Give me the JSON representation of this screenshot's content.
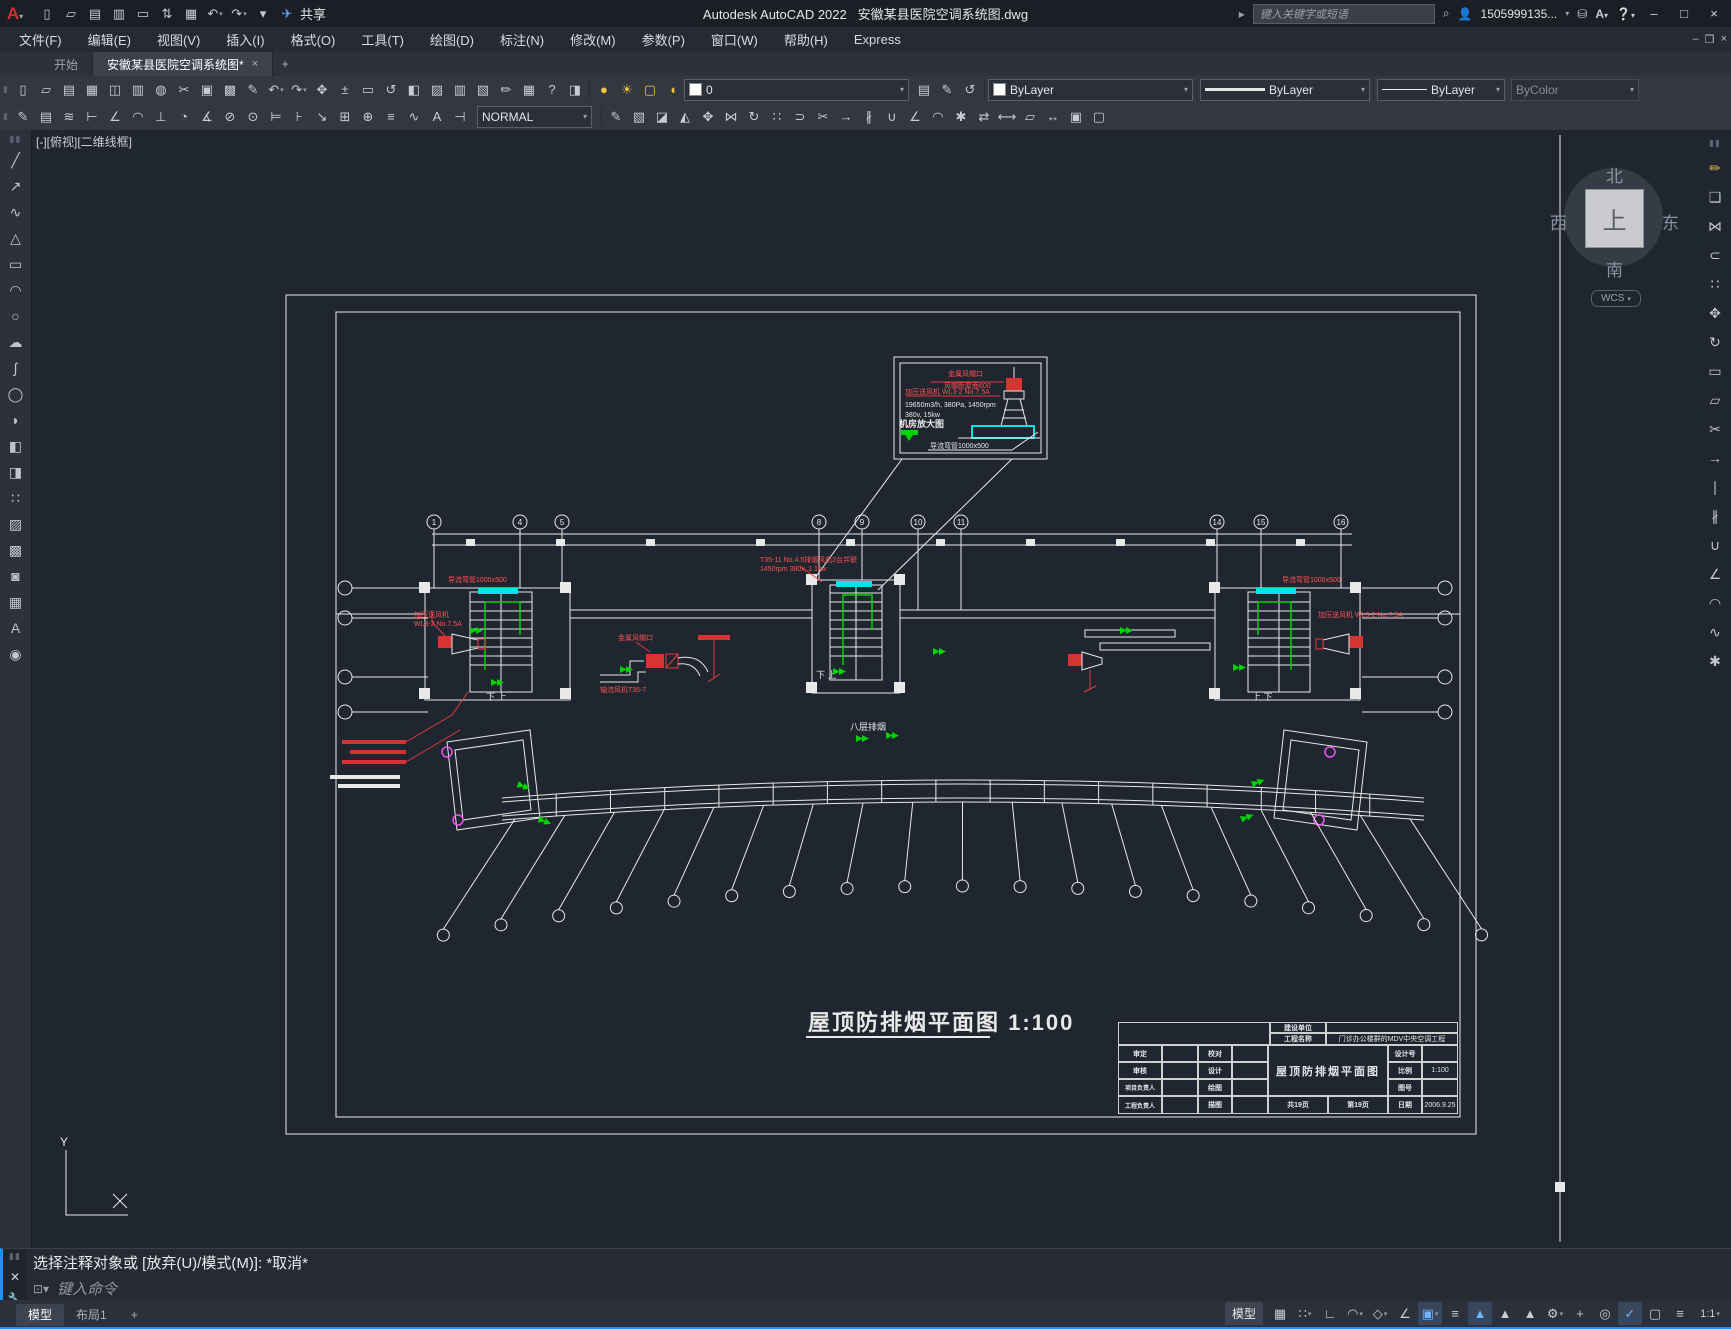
{
  "titlebar": {
    "app_title": "Autodesk AutoCAD 2022",
    "doc_title": "安徽某县医院空调系统图.dwg",
    "share_label": "共享",
    "search_placeholder": "键入关键字或短语",
    "username": "1505999135...",
    "min": "–",
    "max": "□",
    "close": "×",
    "doc_min": "–",
    "doc_restore": "❐",
    "doc_close": "×"
  },
  "menu": {
    "items": [
      "文件(F)",
      "编辑(E)",
      "视图(V)",
      "插入(I)",
      "格式(O)",
      "工具(T)",
      "绘图(D)",
      "标注(N)",
      "修改(M)",
      "参数(P)",
      "窗口(W)",
      "帮助(H)",
      "Express"
    ]
  },
  "tabs": {
    "start": "开始",
    "doc": "安徽某县医院空调系统图*",
    "close": "×",
    "plus": "+"
  },
  "toolbar": {
    "layer_name": "0",
    "color": "ByLayer",
    "lineweight": "ByLayer",
    "linetype": "ByLayer",
    "plotstyle": "ByColor",
    "dimstyle": "NORMAL"
  },
  "icons": {
    "qat": [
      {
        "n": "new",
        "g": "▯"
      },
      {
        "n": "open",
        "g": "▱"
      },
      {
        "n": "save",
        "g": "▤"
      },
      {
        "n": "save-as",
        "g": "▥"
      },
      {
        "n": "plot-stamp",
        "g": "▭"
      },
      {
        "n": "transfer",
        "g": "⇅"
      },
      {
        "n": "print",
        "g": "▦"
      },
      {
        "n": "undo",
        "g": "↶",
        "dd": true
      },
      {
        "n": "redo",
        "g": "↷",
        "dd": true
      },
      {
        "n": "qat-more",
        "g": "▾"
      },
      {
        "n": "share",
        "g": "✈",
        "c": "#58a6ff"
      }
    ],
    "tb1_left": [
      {
        "n": "new-file",
        "g": "▯"
      },
      {
        "n": "open-file",
        "g": "▱"
      },
      {
        "n": "save-file",
        "g": "▤"
      },
      {
        "n": "print",
        "g": "▦"
      },
      {
        "n": "plot-preview",
        "g": "◫"
      },
      {
        "n": "publish",
        "g": "▥"
      },
      {
        "n": "web",
        "g": "◍"
      },
      {
        "n": "cut",
        "g": "✂"
      },
      {
        "n": "copy-clip",
        "g": "▣"
      },
      {
        "n": "paste",
        "g": "▩"
      },
      {
        "n": "match-properties",
        "g": "✎"
      },
      {
        "n": "undo",
        "g": "↶",
        "dd": true
      },
      {
        "n": "redo",
        "g": "↷",
        "dd": true
      },
      {
        "n": "pan",
        "g": "✥"
      },
      {
        "n": "zoom-realtime",
        "g": "±"
      },
      {
        "n": "zoom-window",
        "g": "▭"
      },
      {
        "n": "zoom-previous",
        "g": "↺"
      },
      {
        "n": "properties",
        "g": "◧"
      },
      {
        "n": "design-center",
        "g": "▨"
      },
      {
        "n": "tool-palettes",
        "g": "▥"
      },
      {
        "n": "sheet-set",
        "g": "▧"
      },
      {
        "n": "markup",
        "g": "✏"
      },
      {
        "n": "calculator",
        "g": "▦"
      },
      {
        "n": "help",
        "g": "?"
      },
      {
        "n": "infocenter",
        "g": "◨"
      }
    ],
    "tb1_layer": [
      {
        "n": "layer-on",
        "g": "●",
        "c": "#f5c542"
      },
      {
        "n": "layer-thaw",
        "g": "☀",
        "c": "#f5c542"
      },
      {
        "n": "layer-viewport",
        "g": "▢",
        "c": "#f5c542"
      },
      {
        "n": "layer-lock",
        "g": "◖",
        "c": "#f5c542"
      }
    ],
    "tb1_layer_tools": [
      {
        "n": "layer-properties",
        "g": "▤"
      },
      {
        "n": "layer-match",
        "g": "✎"
      },
      {
        "n": "layer-previous",
        "g": "↺"
      }
    ],
    "tb2_left": [
      {
        "n": "dim-edit",
        "g": "✎"
      },
      {
        "n": "dim-text-edit",
        "g": "▤"
      },
      {
        "n": "dim-update",
        "g": "≋"
      },
      {
        "n": "dim-linear",
        "g": "⊢"
      },
      {
        "n": "dim-aligned",
        "g": "∠"
      },
      {
        "n": "dim-arc",
        "g": "◠"
      },
      {
        "n": "dim-ordinate",
        "g": "⊥"
      },
      {
        "n": "dim-radius",
        "g": "◔"
      },
      {
        "n": "dim-angular",
        "g": "∡"
      },
      {
        "n": "dim-diameter",
        "g": "⊘"
      },
      {
        "n": "dim-center",
        "g": "⊙"
      },
      {
        "n": "dim-baseline",
        "g": "⊨"
      },
      {
        "n": "dim-continue",
        "g": "⊦"
      },
      {
        "n": "dim-leader",
        "g": "↘"
      },
      {
        "n": "dim-tolerance",
        "g": "⊞"
      },
      {
        "n": "dim-oblique",
        "g": "⊕"
      },
      {
        "n": "dim-align-text",
        "g": "≡"
      },
      {
        "n": "dim-style",
        "g": "∿"
      },
      {
        "n": "text-style",
        "g": "A"
      },
      {
        "n": "dim-break",
        "g": "⊣"
      }
    ],
    "tb2_right": [
      {
        "n": "brush",
        "g": "✎"
      },
      {
        "n": "solid-box",
        "g": "▧"
      },
      {
        "n": "solid-wedge",
        "g": "◪"
      },
      {
        "n": "solid-cone",
        "g": "◭"
      },
      {
        "n": "move-3d",
        "g": "✥"
      },
      {
        "n": "mirror-3d",
        "g": "⋈"
      },
      {
        "n": "rotate-3d",
        "g": "↻"
      },
      {
        "n": "array-3d",
        "g": "∷"
      },
      {
        "n": "offset",
        "g": "⊃"
      },
      {
        "n": "trim",
        "g": "✂"
      },
      {
        "n": "extend",
        "g": "→"
      },
      {
        "n": "break",
        "g": "∦"
      },
      {
        "n": "join",
        "g": "∪"
      },
      {
        "n": "chamfer",
        "g": "∠"
      },
      {
        "n": "fillet",
        "g": "◠"
      },
      {
        "n": "explode",
        "g": "✱"
      },
      {
        "n": "align",
        "g": "⇄"
      },
      {
        "n": "stretch",
        "g": "⟷"
      },
      {
        "n": "scale",
        "g": "▱"
      },
      {
        "n": "lengthen",
        "g": "↔"
      },
      {
        "n": "group",
        "g": "▣"
      },
      {
        "n": "ungroup",
        "g": "▢"
      }
    ],
    "leftstrip": [
      {
        "n": "line",
        "g": "╱"
      },
      {
        "n": "construction-line",
        "g": "↗"
      },
      {
        "n": "polyline",
        "g": "∿"
      },
      {
        "n": "polygon",
        "g": "△"
      },
      {
        "n": "rectangle",
        "g": "▭"
      },
      {
        "n": "arc",
        "g": "◠"
      },
      {
        "n": "circle",
        "g": "○"
      },
      {
        "n": "revision-cloud",
        "g": "☁"
      },
      {
        "n": "spline",
        "g": "∫"
      },
      {
        "n": "ellipse",
        "g": "◯"
      },
      {
        "n": "ellipse-arc",
        "g": "◗"
      },
      {
        "n": "insert-block",
        "g": "◧"
      },
      {
        "n": "create-block",
        "g": "◨"
      },
      {
        "n": "point",
        "g": "∷"
      },
      {
        "n": "hatch",
        "g": "▨"
      },
      {
        "n": "gradient",
        "g": "▩"
      },
      {
        "n": "region",
        "g": "◙"
      },
      {
        "n": "table",
        "g": "▦"
      },
      {
        "n": "mtext",
        "g": "A"
      },
      {
        "n": "add-selected",
        "g": "◉"
      }
    ],
    "rightstrip": [
      {
        "n": "erase",
        "g": "✏",
        "c": "#e8b04a"
      },
      {
        "n": "copy",
        "g": "❏"
      },
      {
        "n": "mirror",
        "g": "⋈"
      },
      {
        "n": "offset",
        "g": "⊂"
      },
      {
        "n": "array",
        "g": "∷"
      },
      {
        "n": "move",
        "g": "✥"
      },
      {
        "n": "rotate",
        "g": "↻"
      },
      {
        "n": "scale",
        "g": "▭"
      },
      {
        "n": "stretch",
        "g": "▱"
      },
      {
        "n": "trim",
        "g": "✂"
      },
      {
        "n": "extend",
        "g": "→"
      },
      {
        "n": "break-at-point",
        "g": "∣"
      },
      {
        "n": "break",
        "g": "∦"
      },
      {
        "n": "join",
        "g": "∪"
      },
      {
        "n": "chamfer",
        "g": "∠"
      },
      {
        "n": "fillet",
        "g": "◠"
      },
      {
        "n": "blend",
        "g": "∿"
      },
      {
        "n": "explode",
        "g": "✱"
      }
    ],
    "status_right": [
      {
        "n": "grid",
        "g": "▦"
      },
      {
        "n": "snap-mode",
        "g": "∷",
        "dd": true
      },
      {
        "n": "ortho",
        "g": "∟"
      },
      {
        "n": "polar-tracking",
        "g": "◠",
        "dd": true
      },
      {
        "n": "isodraft",
        "g": "◇",
        "dd": true
      },
      {
        "n": "object-snap-tracking",
        "g": "∠"
      },
      {
        "n": "object-snap",
        "g": "▣",
        "dd": true,
        "a": true
      },
      {
        "n": "lineweight-display",
        "g": "≡"
      },
      {
        "n": "annotation-visibility",
        "g": "▲",
        "a": true
      },
      {
        "n": "autoscale",
        "g": "▲"
      },
      {
        "n": "annotation-scale-icon",
        "g": "▲"
      },
      {
        "n": "workspace-gear",
        "g": "⚙",
        "dd": true
      },
      {
        "n": "crosshair",
        "g": "+"
      },
      {
        "n": "isolate-objects",
        "g": "◎"
      },
      {
        "n": "hardware-acceleration",
        "g": "✓",
        "a": true
      },
      {
        "n": "clean-screen",
        "g": "▢"
      },
      {
        "n": "customize",
        "g": "≡"
      }
    ]
  },
  "viewport": {
    "label": "[-][俯视][二维线框]",
    "compass": {
      "n": "北",
      "s": "南",
      "w": "西",
      "e": "东",
      "up": "上",
      "wcs": "WCS"
    }
  },
  "drawing": {
    "plan_title": "屋顶防排烟平面图 1:100",
    "grid_bubbles": [
      {
        "n": "1",
        "x": 434
      },
      {
        "n": "4",
        "x": 520
      },
      {
        "n": "5",
        "x": 562
      },
      {
        "n": "8",
        "x": 819
      },
      {
        "n": "9",
        "x": 862
      },
      {
        "n": "10",
        "x": 918
      },
      {
        "n": "11",
        "x": 961
      },
      {
        "n": "14",
        "x": 1217
      },
      {
        "n": "15",
        "x": 1261
      },
      {
        "n": "16",
        "x": 1341
      }
    ],
    "detail": {
      "l1": "金属风帽口",
      "l2": "风帽距屋面600",
      "l3": "加压送风机 WL3-2 No.7.5A",
      "l4": "19650m3/h, 380Pa, 1450rpm",
      "l5": "380v, 15kw",
      "l6": "机房放大图",
      "l7": "导流弯管1000x500"
    },
    "ann": {
      "left_duct": "导流弯管1000x500",
      "left_fan1": "加压送风机",
      "left_fan2": "WL3-2 No.7.5A",
      "mid_cap": "金属风帽口",
      "mid_fan": "轴流风机T35-7",
      "center_fan1": "T35-11 No.4.5排烟风机2台并联",
      "center_fan2": "1450rpm 380v, 1.1kw",
      "right_duct": "导流弯管1000x500",
      "right_fan": "加压送风机 WL3-2 No.7.5A",
      "zone": "八层排烟",
      "stair_left": "下  上",
      "stair_center": "下  上",
      "stair_right": "上  下",
      "ucs_y": "Y"
    },
    "titleblock": {
      "owner_label": "建设单位",
      "owner": "",
      "project_label": "工程名称",
      "project": "门诊办公楼群的MDV中央空调工程",
      "rows": [
        [
          "审定",
          "校对"
        ],
        [
          "审核",
          "设计"
        ],
        [
          "项目负责人",
          "绘图"
        ],
        [
          "工程负责人",
          "描图"
        ]
      ],
      "drawing_name": "屋顶防排烟平面图",
      "design_no_label": "设计号",
      "scale_label": "比例",
      "scale": "1:100",
      "sheet_no_label": "图号",
      "date_label": "日期",
      "date": "2006.9.25",
      "pages_total": "共19页",
      "page_no": "第19页"
    }
  },
  "command": {
    "prompt": "选择注释对象或  [放弃(U)/模式(M)]:  *取消*",
    "placeholder": "键入命令"
  },
  "statusbar": {
    "model_tab": "模型",
    "layout_tab": "布局1",
    "plus": "+",
    "model_button": "模型",
    "annotation_scale": "1:1"
  }
}
